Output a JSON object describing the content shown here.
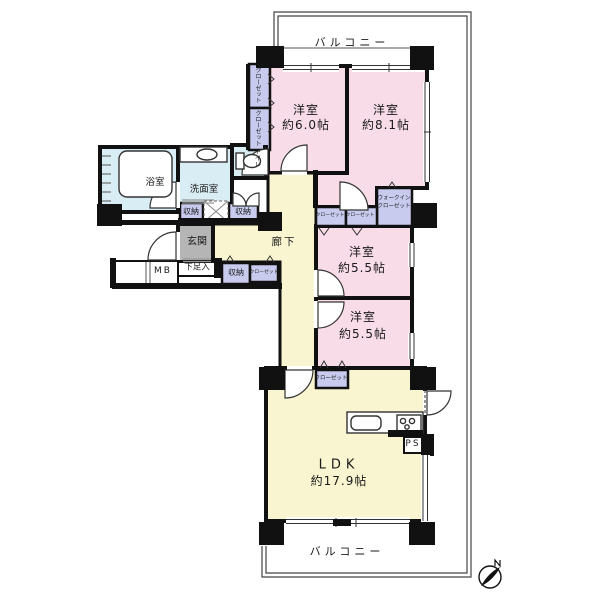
{
  "balcony": {
    "top_label": "バルコニー",
    "bottom_label": "バルコニー"
  },
  "rooms": {
    "western_6_0": {
      "name": "洋室",
      "size": "約6.0帖"
    },
    "western_8_1": {
      "name": "洋室",
      "size": "約8.1帖"
    },
    "western_5_5a": {
      "name": "洋室",
      "size": "約5.5帖"
    },
    "western_5_5b": {
      "name": "洋室",
      "size": "約5.5帖"
    },
    "ldk": {
      "name": "LDK",
      "size": "約17.9帖"
    },
    "bath": {
      "name": "浴室"
    },
    "washroom": {
      "name": "洗面室"
    },
    "toilet": {
      "name": "トイレ"
    },
    "entrance": {
      "name": "玄関"
    },
    "hallway": {
      "name": "廊下"
    }
  },
  "storage": {
    "closet_label": "クローゼット",
    "walk_in_closet_line1": "ウォークイン",
    "walk_in_closet_line2": "クローゼット",
    "shuno_label": "収納",
    "shoe_cabinet_label": "下足入",
    "meter_box_label": "MB",
    "pipe_space_label": "PS"
  },
  "colors": {
    "room_pink": "#f8dce8",
    "hallway_yellow": "#f9f5d0",
    "wet_area_blue": "#d9edf4",
    "closet_lavender": "#c8cbee",
    "entrance_gray": "#b5b5b5",
    "wall_black": "#111111"
  }
}
